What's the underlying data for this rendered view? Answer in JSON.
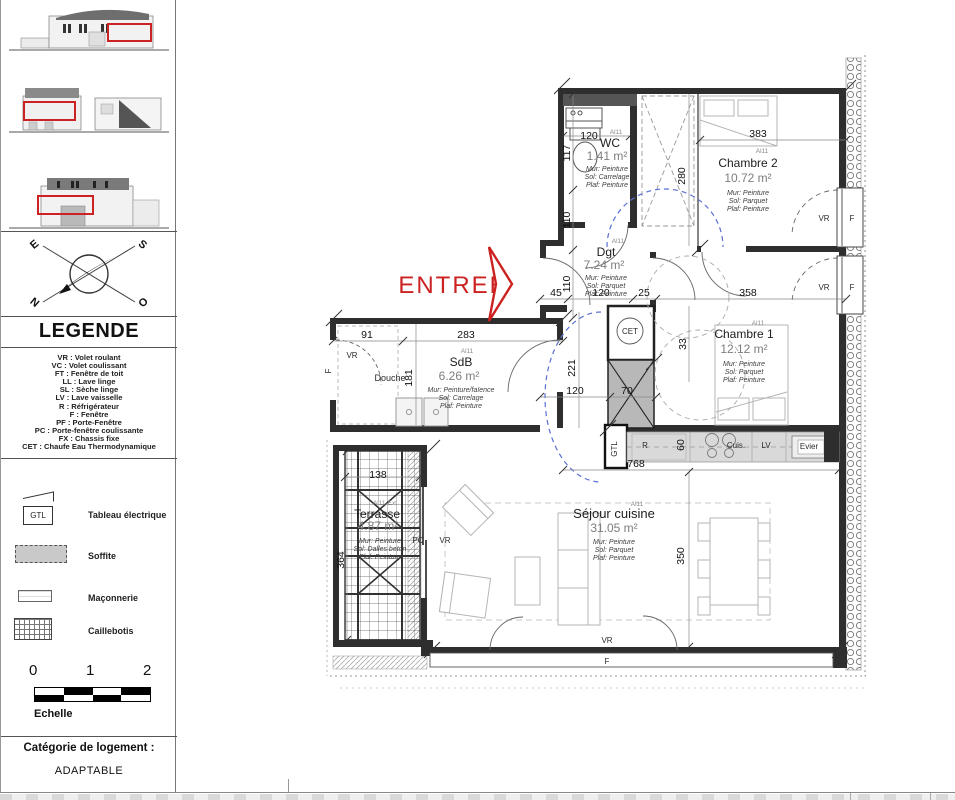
{
  "sidebar": {
    "legend_title": "LEGENDE",
    "abbreviations": [
      "VR : Volet roulant",
      "VC : Volet coulissant",
      "FT : Fenêtre de toit",
      "LL : Lave linge",
      "SL : Sèche linge",
      "LV : Lave vaisselle",
      "R : Réfrigérateur",
      "F : Fenêtre",
      "PF : Porte-Fenêtre",
      "PC : Porte-fenêtre coulissante",
      "FX : Chassis fixe",
      "CET : Chaufe Eau Thermodynamique"
    ],
    "symbols": [
      {
        "key": "GTL",
        "label": "Tableau électrique"
      },
      {
        "key": "soffite",
        "label": "Soffite"
      },
      {
        "key": "maconnerie",
        "label": "Maçonnerie"
      },
      {
        "key": "caillebotis",
        "label": "Caillebotis"
      }
    ],
    "compass": {
      "e": "E",
      "s": "S",
      "n": "N",
      "o": "O"
    },
    "scale": {
      "t0": "0",
      "t1": "1",
      "t2": "2",
      "label": "Echelle"
    },
    "category": {
      "title": "Catégorie de logement :",
      "value": "ADAPTABLE"
    }
  },
  "plan": {
    "entry_label": "ENTREE",
    "rooms": {
      "wc": {
        "code": "Al11",
        "name": "WC",
        "area": "1.41 m²",
        "mur": "Mur: Peinture",
        "sol": "Sol: Carrelage",
        "plaf": "Plaf: Peinture"
      },
      "chambre2": {
        "code": "Al11",
        "name": "Chambre 2",
        "area": "10.72 m²",
        "mur": "Mur: Peinture",
        "sol": "Sol: Parquet",
        "plaf": "Plaf: Peinture"
      },
      "dgt": {
        "code": "Al11",
        "name": "Dgt",
        "area": "7.24 m²",
        "mur": "Mur: Peinture",
        "sol": "Sol: Parquet",
        "plaf": "Plaf: Peinture"
      },
      "chambre1": {
        "code": "Al11",
        "name": "Chambre 1",
        "area": "12.12 m²",
        "mur": "Mur: Peinture",
        "sol": "Sol: Parquet",
        "plaf": "Plaf: Peinture"
      },
      "sdb": {
        "code": "Al11",
        "name": "SdB",
        "area": "6.26 m²",
        "mur": "Mur: Peinture/faïence",
        "sol": "Sol: Carrelage",
        "plaf": "Plaf: Peinture"
      },
      "sejour": {
        "code": "Al11",
        "name": "Séjour cuisine",
        "area": "31.05 m²",
        "mur": "Mur: Peinture",
        "sol": "Sol: Parquet",
        "plaf": "Plaf: Peinture"
      },
      "terrasse": {
        "code": "Al11-Ext",
        "name": "Terrasse",
        "area": "4.87 m²",
        "mur": "Mur: Peinture",
        "sol": "Sol: Dalles beton",
        "plaf": "Plaf: Peinture"
      }
    },
    "dims": {
      "wc_top": "120",
      "wc_left": "117",
      "hall_upper": "110",
      "hall_lower": "110",
      "entry": "45",
      "hall_w": "120",
      "hall_w2": "25",
      "ch1_top": "358",
      "ch2_top": "383",
      "ch2_side": "280",
      "sdb_top_a": "91",
      "sdb_top_b": "283",
      "sdb_left": "181",
      "corridor": "221",
      "sdb_bottom": "120",
      "duct": "70",
      "ch1_side": "33",
      "kitchen_run": "768",
      "counter_depth": "60",
      "sejour_side": "350",
      "terrasse_top": "138",
      "terrasse_side": "364"
    },
    "labels": {
      "vr": "VR",
      "f": "F",
      "pc": "PC",
      "douche": "Douche",
      "cet": "CET",
      "gtl": "GTL",
      "fridge": "R",
      "hob": "Cuis.",
      "dishwasher": "LV",
      "sink": "Evier"
    }
  },
  "colors": {
    "accent_red": "#cc2222",
    "blue_dash": "#5b6fd4",
    "wall": "#2e2e2e",
    "soffite_gray": "#b8b8b8"
  }
}
